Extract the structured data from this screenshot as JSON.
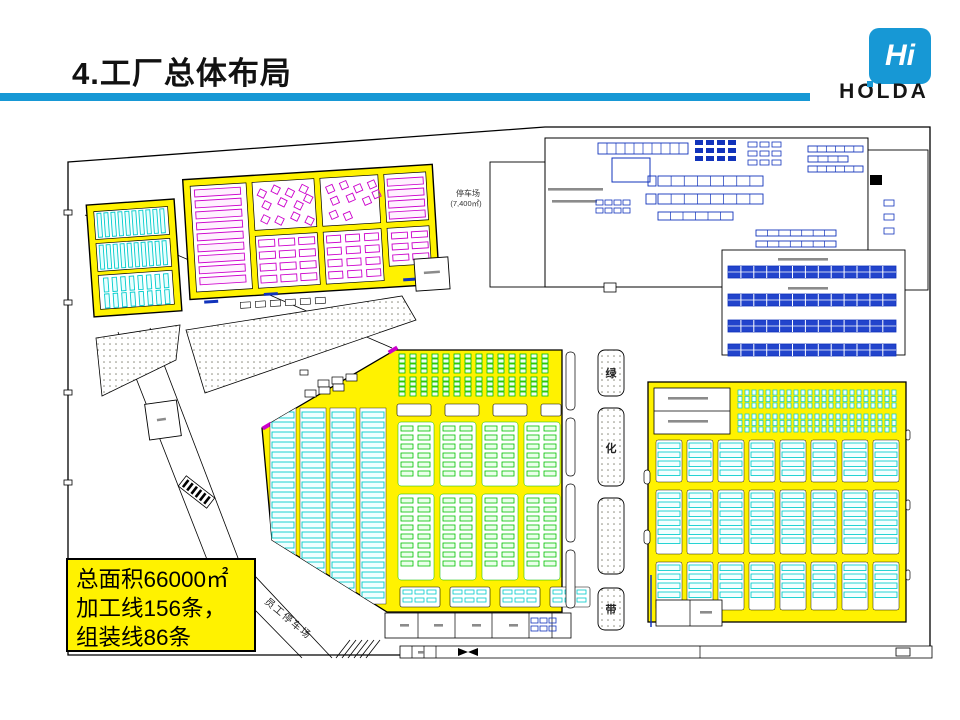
{
  "slide": {
    "title": "4.工厂总体布局"
  },
  "logo": {
    "monogram": "Hi",
    "brand": "HOLDA"
  },
  "callout": {
    "lines": [
      "总面积66000㎡",
      "加工线156条，",
      "组装线86条"
    ]
  },
  "plan": {
    "labels": {
      "green_belt": [
        "绿",
        "化",
        "带"
      ],
      "employee_parking": "员工停车场",
      "visitor_parking": "停车场",
      "visitor_parking_area": "(7,400㎡)"
    }
  },
  "palette": {
    "header_blue": "#1798D5",
    "cad_yellow": "#FFF200",
    "machine_cyan": "#00CCCC",
    "machine_magenta": "#CC00CC",
    "machine_green": "#00C000",
    "machine_blue": "#1133BB",
    "rack_fill": "#2244CC",
    "outline": "#000000",
    "dot_gray": "#88887A",
    "text_dark": "#222222"
  }
}
